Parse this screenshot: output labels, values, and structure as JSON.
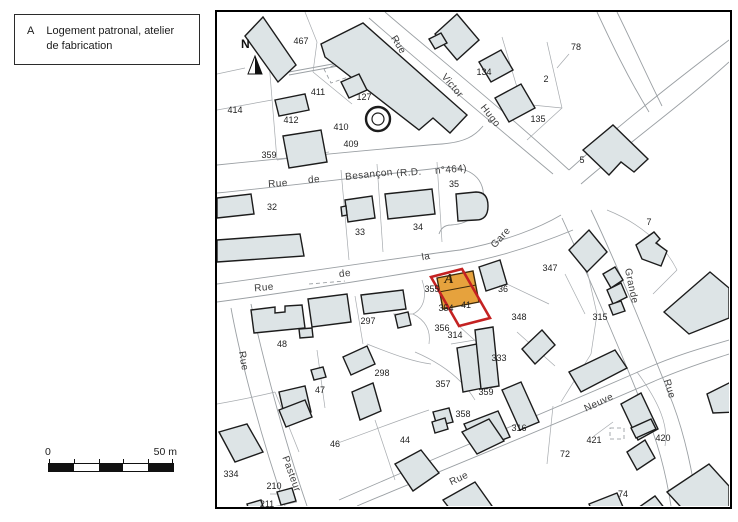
{
  "legend": {
    "code": "A",
    "text": "Logement patronal, atelier de fabrication"
  },
  "scale_bar": {
    "start": "0",
    "end": "50 m"
  },
  "colors": {
    "building_fill": "#dde4e6",
    "highlight_fill": "#e6a23d",
    "highlight_outline": "#c42222",
    "line_gray": "#9ba0a4"
  },
  "map": {
    "north_label": "N",
    "marker": {
      "text": "A",
      "x": 232,
      "y": 268
    },
    "street_labels": [
      {
        "text": "Rue",
        "x": 181,
        "y": 33,
        "rot": 58
      },
      {
        "text": "Victor",
        "x": 235,
        "y": 74,
        "rot": 50
      },
      {
        "text": "Hugo",
        "x": 273,
        "y": 104,
        "rot": 52
      },
      {
        "text": "Rue",
        "x": 61,
        "y": 172,
        "rot": -4
      },
      {
        "text": "de",
        "x": 97,
        "y": 168,
        "rot": -5
      },
      {
        "text": "Besançon",
        "x": 152,
        "y": 163,
        "rot": -6
      },
      {
        "text": "(R.D.",
        "x": 192,
        "y": 161,
        "rot": -4
      },
      {
        "text": "n°464)",
        "x": 234,
        "y": 158,
        "rot": -5
      },
      {
        "text": "Rue",
        "x": 47,
        "y": 276,
        "rot": -5
      },
      {
        "text": "de",
        "x": 128,
        "y": 262,
        "rot": -8
      },
      {
        "text": "la",
        "x": 209,
        "y": 245,
        "rot": -10
      },
      {
        "text": "Gare",
        "x": 284,
        "y": 226,
        "rot": -48
      },
      {
        "text": "Grande",
        "x": 414,
        "y": 274,
        "rot": 78
      },
      {
        "text": "Rue",
        "x": 452,
        "y": 377,
        "rot": 72
      },
      {
        "text": "Rue",
        "x": 26,
        "y": 349,
        "rot": 80
      },
      {
        "text": "Pasteur",
        "x": 74,
        "y": 462,
        "rot": 70
      },
      {
        "text": "Neuve",
        "x": 382,
        "y": 391,
        "rot": -25
      },
      {
        "text": "Rue",
        "x": 242,
        "y": 467,
        "rot": -25
      }
    ],
    "parcel_labels": [
      {
        "text": "467",
        "x": 84,
        "y": 29
      },
      {
        "text": "127",
        "x": 147,
        "y": 85
      },
      {
        "text": "411",
        "x": 101,
        "y": 80
      },
      {
        "text": "410",
        "x": 124,
        "y": 115
      },
      {
        "text": "409",
        "x": 134,
        "y": 132
      },
      {
        "text": "412",
        "x": 74,
        "y": 108
      },
      {
        "text": "414",
        "x": 18,
        "y": 98
      },
      {
        "text": "359",
        "x": 52,
        "y": 143
      },
      {
        "text": "134",
        "x": 267,
        "y": 60
      },
      {
        "text": "2",
        "x": 329,
        "y": 67
      },
      {
        "text": "135",
        "x": 321,
        "y": 107
      },
      {
        "text": "78",
        "x": 359,
        "y": 35
      },
      {
        "text": "5",
        "x": 365,
        "y": 148
      },
      {
        "text": "7",
        "x": 432,
        "y": 210
      },
      {
        "text": "347",
        "x": 333,
        "y": 256
      },
      {
        "text": "36",
        "x": 286,
        "y": 277
      },
      {
        "text": "355",
        "x": 215,
        "y": 277
      },
      {
        "text": "41",
        "x": 249,
        "y": 293
      },
      {
        "text": "354",
        "x": 229,
        "y": 296
      },
      {
        "text": "348",
        "x": 302,
        "y": 305
      },
      {
        "text": "356",
        "x": 225,
        "y": 316
      },
      {
        "text": "314",
        "x": 238,
        "y": 323
      },
      {
        "text": "297",
        "x": 151,
        "y": 309
      },
      {
        "text": "48",
        "x": 65,
        "y": 332
      },
      {
        "text": "298",
        "x": 165,
        "y": 361
      },
      {
        "text": "47",
        "x": 103,
        "y": 378
      },
      {
        "text": "315",
        "x": 383,
        "y": 305
      },
      {
        "text": "333",
        "x": 282,
        "y": 346
      },
      {
        "text": "357",
        "x": 226,
        "y": 372
      },
      {
        "text": "359",
        "x": 269,
        "y": 380
      },
      {
        "text": "358",
        "x": 246,
        "y": 402
      },
      {
        "text": "316",
        "x": 302,
        "y": 416
      },
      {
        "text": "72",
        "x": 348,
        "y": 442
      },
      {
        "text": "421",
        "x": 377,
        "y": 428
      },
      {
        "text": "420",
        "x": 446,
        "y": 426
      },
      {
        "text": "74",
        "x": 406,
        "y": 482
      },
      {
        "text": "46",
        "x": 118,
        "y": 432
      },
      {
        "text": "44",
        "x": 188,
        "y": 428
      },
      {
        "text": "334",
        "x": 14,
        "y": 462
      },
      {
        "text": "210",
        "x": 57,
        "y": 474
      },
      {
        "text": "211",
        "x": 50,
        "y": 492
      },
      {
        "text": "32",
        "x": 55,
        "y": 195
      },
      {
        "text": "33",
        "x": 143,
        "y": 220
      },
      {
        "text": "34",
        "x": 201,
        "y": 215
      },
      {
        "text": "35",
        "x": 237,
        "y": 172
      }
    ]
  }
}
